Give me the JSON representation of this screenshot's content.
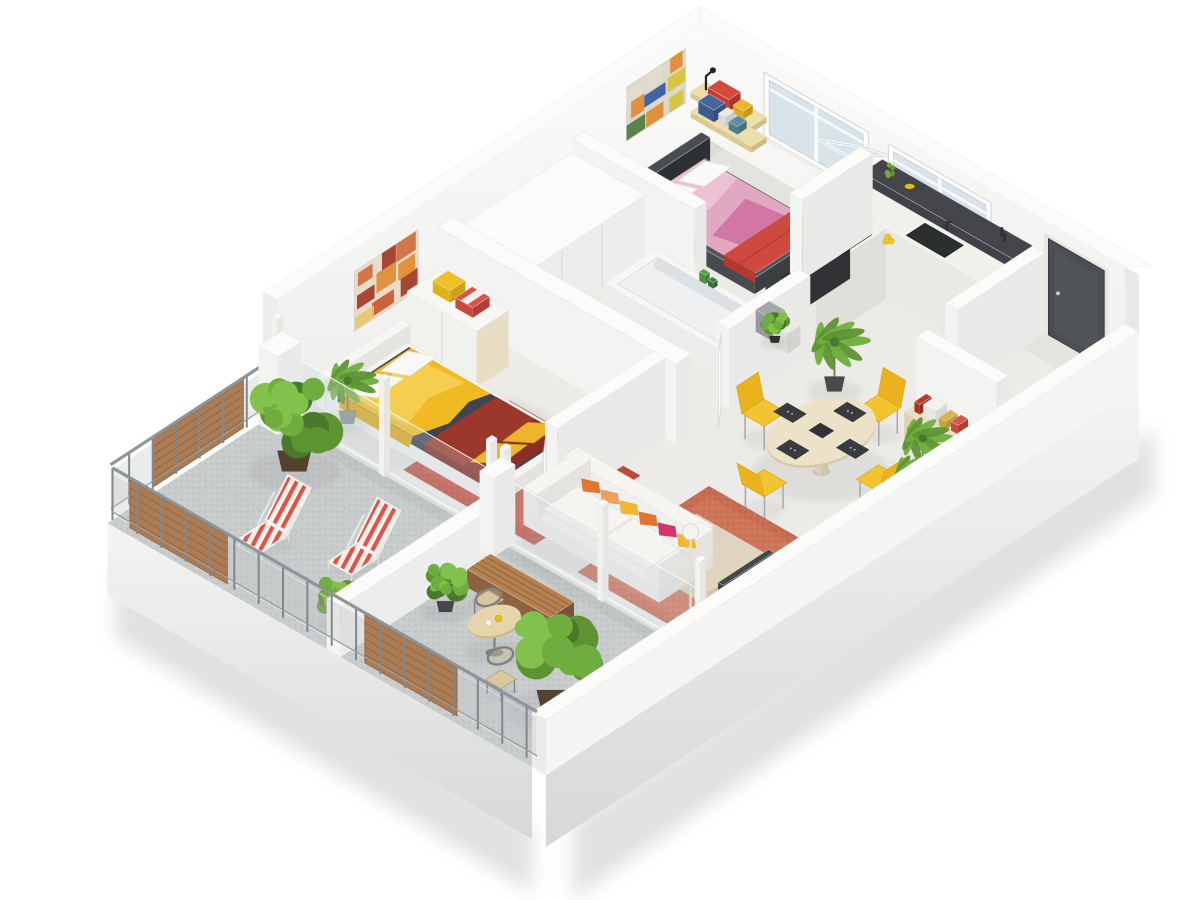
{
  "meta": {
    "app": "floor-plan-render",
    "description": "isometric 3d dollhouse cutaway of a two bedroom apartment with wraparound balcony"
  },
  "projection": {
    "ux": 0.87,
    "uy": 0.5,
    "vx": -0.84,
    "vy": 0.55,
    "ox": 700,
    "oy": 118
  },
  "palette": {
    "bg": "#ffffff",
    "wallTop": "#fbfbfa",
    "wallSE": "#e9eae8",
    "wallSW": "#f3f3f1",
    "floorIn": "#edebe7",
    "floorBalc": "#c9cccd",
    "glassWin": "#d8e4ea",
    "door": "#4b4e52",
    "counterDark": "#45464a",
    "counterWhite": "#f2f0ea",
    "sinkDark": "#2c2f31",
    "cooktop": "#141617",
    "tub": "#f5f6f5",
    "tubInner": "#eef0f1",
    "tan": "#e5d9b8",
    "woodShelf": "#e8dca6",
    "rugRed": "#c2483a",
    "rugTerra": "#c96b51",
    "bedDark": "#44474b",
    "pink": "#ecc2d2",
    "magenta": "#cf6f9f",
    "redThrow": "#cf4a3e",
    "mattressM": "#3f4451",
    "yellow": "#f0ba24",
    "yellowLight": "#f8d45c",
    "redRunner": "#9c372c",
    "sofaWhite": "#f1f0ed",
    "pillowOrange": "#e2762e",
    "pillowPeach": "#eda05e",
    "pillowYellow": "#f2b82c",
    "pillowMagenta": "#d6336c",
    "pillowCream": "#f0e8d8",
    "tableTan": "#ece2c8",
    "chairYellow": "#f3c431",
    "chairYellowDk": "#eab31e",
    "metal": "#85898b",
    "wood": "#ab7c54",
    "woodDark": "#8d6240",
    "planterBrown": "#54422f",
    "green1": "#6fae3e",
    "green2": "#5d9431",
    "green3": "#82c24c",
    "green4": "#49792a",
    "trunk": "#8a7a5a",
    "tvDark": "#35383b",
    "shadow": "#c7c9ca"
  },
  "scene": {
    "items": [
      {
        "t": "floor",
        "name": "indoor-floor",
        "p1": 16,
        "q1": 16,
        "p2": 504,
        "q2": 516,
        "fill": "floorIn"
      },
      {
        "t": "floor",
        "name": "balcony-floor",
        "p1": 16,
        "q1": 516,
        "p2": 504,
        "q2": 722,
        "fill": "floorBalc",
        "speck": true,
        "tiles": true
      },
      {
        "t": "wallshade",
        "name": "floor-shadow-nw",
        "pts": [
          [
            16,
            16,
            0
          ],
          [
            44,
            16,
            0
          ],
          [
            44,
            516,
            0
          ],
          [
            16,
            516,
            0
          ]
        ],
        "op": 0.05
      },
      {
        "t": "wallshade",
        "name": "floor-shadow-ne",
        "pts": [
          [
            16,
            16,
            0
          ],
          [
            504,
            16,
            0
          ],
          [
            504,
            44,
            0
          ],
          [
            16,
            44,
            0
          ]
        ],
        "op": 0.04
      },
      {
        "t": "wallshade",
        "name": "floor-shadow-balcony",
        "pts": [
          [
            16,
            516,
            0
          ],
          [
            504,
            516,
            0
          ],
          [
            504,
            534,
            0
          ],
          [
            16,
            534,
            0
          ]
        ],
        "op": 0.06
      },
      {
        "t": "softshadow",
        "name": "ground-shadow-se",
        "pts": [
          [
            520,
            24,
            -30
          ],
          [
            520,
            716,
            -44
          ],
          [
            520,
            716,
            -120
          ],
          [
            520,
            24,
            -95
          ]
        ],
        "dx": 22,
        "dy": 8
      },
      {
        "t": "softshadow",
        "name": "ground-shadow-sw",
        "pts": [
          [
            20,
            722,
            -44
          ],
          [
            500,
            722,
            -56
          ],
          [
            500,
            722,
            -122
          ],
          [
            20,
            722,
            -106
          ]
        ],
        "dx": 4,
        "dy": 6
      },
      {
        "t": "quad",
        "name": "base-slab-sw",
        "pts": [
          [
            16,
            722,
            0
          ],
          [
            504,
            722,
            0
          ],
          [
            504,
            722,
            -72
          ],
          [
            16,
            722,
            -72
          ]
        ],
        "fill": "url(#gBase)"
      },
      {
        "t": "facadeNW",
        "name": "northwest-wall"
      },
      {
        "t": "art",
        "name": "wall-art-multicolor",
        "q1": 34,
        "q2": 104,
        "h1": 42,
        "h2": 96,
        "bg": "#ddd8cc",
        "colors": [
          "#b33f35",
          "#2d56a0",
          "#e08a2c",
          "#e3dccd",
          "#d8c232",
          "#7a2f2f",
          "#4a7a3a",
          "#c84a3e",
          "#88a8c8"
        ],
        "seed": 7
      },
      {
        "t": "art",
        "name": "wall-art-orange",
        "q1": 352,
        "q2": 428,
        "h1": 30,
        "h2": 90,
        "bg": "#e8ddca",
        "colors": [
          "#c8552c",
          "#e08a2c",
          "#a03525",
          "#e8c86a",
          "#8a4a20",
          "#f0e2c8",
          "#d06a3a"
        ],
        "seed": 3
      },
      {
        "t": "facadeNE",
        "name": "northeast-wall"
      },
      {
        "t": "window",
        "name": "bedroom-window",
        "p1": 95,
        "p2": 203,
        "h1": 40,
        "h2": 94,
        "open": true
      },
      {
        "t": "window",
        "name": "kitchen-window",
        "p1": 238,
        "p2": 344,
        "h1": 44,
        "h2": 94
      },
      {
        "t": "door",
        "name": "entrance-door",
        "p1": 416,
        "p2": 480,
        "h": 96
      },
      {
        "t": "box",
        "name": "kitchen-back-counter",
        "p1": 225,
        "q1": 16,
        "p2": 398,
        "q2": 40,
        "h": 80,
        "top": "counterDark",
        "se": "#34363a",
        "sw": "#404247"
      },
      {
        "t": "kitchendecor",
        "name": "kitchen-decor"
      },
      {
        "t": "box",
        "name": "kitchen-counter",
        "p1": 225,
        "q1": 40,
        "p2": 398,
        "q2": 72,
        "h": 70,
        "top": "counterWhite",
        "se": "#e0ded8",
        "sw": "#ebe9e3"
      },
      {
        "t": "quadTop",
        "name": "kitchen-sink",
        "p1": 302,
        "q1": 45,
        "p2": 346,
        "q2": 67,
        "h": 70.5,
        "fill": "sinkDark",
        "stroke": "#1e2022"
      },
      {
        "t": "box",
        "name": "kitchen-peninsula",
        "p1": 225,
        "q1": 72,
        "p2": 283,
        "q2": 155,
        "h": 70,
        "top": "counterWhite",
        "se": "#e0ded8",
        "sw": "#ebe9e3"
      },
      {
        "t": "box",
        "name": "kitchen-peninsula-shelf",
        "p1": 225,
        "q1": 72,
        "p2": 242,
        "q2": 155,
        "h": 74,
        "top": "counterDark",
        "se": "#303236",
        "sw": "#3a3c40"
      },
      {
        "t": "quadTop",
        "name": "cooktop",
        "p1": 250,
        "q1": 86,
        "p2": 280,
        "q2": 122,
        "h": 70.5,
        "fill": "cooktop",
        "stroke": "#000000"
      },
      {
        "t": "pot",
        "name": "cooking-pot",
        "p": 263,
        "q": 100,
        "h": 70.5
      },
      {
        "t": "lemons",
        "name": "lemons",
        "p": 292,
        "q": 79,
        "h": 70.5
      },
      {
        "t": "shelves",
        "name": "wall-shelves"
      },
      {
        "t": "bed2",
        "name": "single-bed"
      },
      {
        "t": "wall",
        "name": "partition-wall",
        "p1": 200,
        "q1": 16,
        "p2": 214,
        "q2": 100
      },
      {
        "t": "wall",
        "name": "partition-wall",
        "p1": 16,
        "q1": 155,
        "p2": 157,
        "q2": 169
      },
      {
        "t": "wall",
        "name": "partition-wall",
        "p1": 398,
        "q1": 16,
        "p2": 412,
        "q2": 120
      },
      {
        "t": "wall",
        "name": "partition-wall",
        "p1": 412,
        "q1": 155,
        "p2": 504,
        "q2": 169
      },
      {
        "t": "box",
        "name": "hallway-closet",
        "p1": 16,
        "q1": 169,
        "p2": 100,
        "q2": 315,
        "h": 66,
        "top": "wallTop",
        "se": "#eceded",
        "sw": "#f4f4f2",
        "seamsSE": [
          220,
          268
        ]
      },
      {
        "t": "tub",
        "name": "bathtub",
        "p1": 118,
        "q1": 175,
        "p2": 268,
        "q2": 237
      },
      {
        "t": "wall",
        "name": "bathroom-wall",
        "p1": 276,
        "q1": 169,
        "p2": 290,
        "q2": 266
      },
      {
        "t": "doorleaf",
        "name": "bathroom-door",
        "a": [
          283,
          268
        ],
        "b": [
          301,
          290
        ]
      },
      {
        "t": "wall",
        "name": "partition-wall",
        "p1": 16,
        "q1": 311,
        "p2": 290,
        "q2": 329
      },
      {
        "t": "wardrobe",
        "name": "wardrobe"
      },
      {
        "t": "rug",
        "name": "red-rug",
        "p1": 148,
        "q1": 380,
        "p2": 298,
        "q2": 506,
        "fill": "rugRed",
        "inner": "#cb5244"
      },
      {
        "t": "bedM",
        "name": "double-bed"
      },
      {
        "t": "plantPalm",
        "name": "palm-plant",
        "p": 70,
        "q": 492,
        "s": 26,
        "pot": "#8a8f92"
      },
      {
        "t": "wall",
        "name": "partition-wall",
        "p1": 264,
        "q1": 329,
        "p2": 278,
        "q2": 458
      },
      {
        "t": "doorleaf",
        "name": "bedroom-door",
        "a": [
          271,
          464
        ],
        "b": [
          289,
          486
        ]
      },
      {
        "t": "stools",
        "name": "stools"
      },
      {
        "t": "plantPalm",
        "name": "palm-plant",
        "p": 338,
        "q": 190,
        "s": 30,
        "pot": "#4a4a4a"
      },
      {
        "t": "plantBush",
        "name": "potted-plant",
        "p": 256,
        "q": 176,
        "s": 13,
        "pot": "#2f2f2f"
      },
      {
        "t": "console",
        "name": "entry-console",
        "p1": 424,
        "q1": 172,
        "p2": 494,
        "q2": 196
      },
      {
        "t": "dining",
        "name": "dining-set",
        "cx": 405,
        "cy": 275
      },
      {
        "t": "plantPalm",
        "name": "palm-plant",
        "p": 476,
        "q": 228,
        "s": 26,
        "pot": "#8a8f92"
      },
      {
        "t": "plantPalm",
        "name": "palm-plant",
        "p": 492,
        "q": 260,
        "s": 21,
        "pot": "#8a8f92"
      },
      {
        "t": "rug",
        "name": "terracotta-rug",
        "p1": 350,
        "q1": 352,
        "p2": 498,
        "q2": 508,
        "fill": "rugTerra",
        "inner": "#d0775c"
      },
      {
        "t": "coffee",
        "name": "coffee-table"
      },
      {
        "t": "tvunit",
        "name": "tv-unit"
      },
      {
        "t": "sofa",
        "name": "sofa"
      },
      {
        "t": "lamp",
        "name": "floor-lamp",
        "p": 468,
        "q": 496
      },
      {
        "t": "glassrun",
        "name": "glass-wall",
        "p1": 16,
        "p2": 262,
        "q": 516,
        "posts": [
          16,
          139,
          262
        ]
      },
      {
        "t": "glassrun",
        "name": "glass-wall",
        "p1": 278,
        "p2": 502,
        "q": 516,
        "posts": [
          278,
          390,
          502
        ]
      },
      {
        "t": "railing",
        "name": "balcony-railing-nw",
        "axis": "v",
        "at": 12,
        "a1": 524,
        "a2": 714,
        "wood": [
          [
            556,
            664
          ]
        ]
      },
      {
        "t": "wall",
        "name": "balcony-pillar",
        "p1": 16,
        "q1": 514,
        "p2": 38,
        "q2": 542,
        "h": 78
      },
      {
        "t": "plantBush",
        "name": "balcony-tree",
        "p": 82,
        "q": 568,
        "s": 40,
        "pot": "planterBrown"
      },
      {
        "t": "deckchair",
        "name": "deck-chair",
        "p": 208,
        "q": 618
      },
      {
        "t": "deckchair",
        "name": "deck-chair",
        "p": 132,
        "q": 646
      },
      {
        "t": "plantBush",
        "name": "balcony-shrub",
        "p": 252,
        "q": 690,
        "s": 19,
        "pot": "planterBrown"
      },
      {
        "t": "box",
        "name": "balcony-divider",
        "p1": 268,
        "q1": 540,
        "p2": 284,
        "q2": 722,
        "h": 50,
        "top": "wallTop",
        "se": "#eceded",
        "sw": "#f4f4f2"
      },
      {
        "t": "wall",
        "name": "divider-pillar",
        "p1": 268,
        "q1": 514,
        "p2": 284,
        "q2": 540,
        "h": 78
      },
      {
        "t": "bench",
        "name": "bench",
        "p1": 296,
        "q1": 556,
        "p2": 392,
        "q2": 584
      },
      {
        "t": "bistrochair",
        "name": "bistro-chair",
        "p": 334,
        "q": 598,
        "side": -1
      },
      {
        "t": "plantBush",
        "name": "potted-tree",
        "p": 306,
        "q": 620,
        "s": 21,
        "pot": "#474747"
      },
      {
        "t": "bistro",
        "name": "bistro-table",
        "p": 374,
        "q": 632
      },
      {
        "t": "plantBush",
        "name": "balcony-bush",
        "p": 466,
        "q": 656,
        "s": 42,
        "pot": "planterBrown"
      },
      {
        "t": "bistrochair",
        "name": "bistro-chair",
        "p": 416,
        "q": 668,
        "side": 1
      },
      {
        "t": "quad",
        "name": "base-slab-se",
        "pts": [
          [
            520,
            16,
            0
          ],
          [
            520,
            722,
            0
          ],
          [
            520,
            722,
            -72
          ],
          [
            520,
            16,
            -72
          ]
        ],
        "fill": "url(#gBase)"
      },
      {
        "t": "box",
        "name": "southeast-parapet",
        "p1": 504,
        "q1": 16,
        "p2": 520,
        "q2": 722,
        "h": 55,
        "top": "wallTop",
        "se": "#f5f5f4",
        "sw": "#ebebea"
      },
      {
        "t": "railing",
        "name": "balcony-railing-sw",
        "axis": "u",
        "at": 716,
        "a1": 16,
        "a2": 504,
        "wood": [
          [
            36,
            148
          ],
          [
            306,
            412
          ]
        ]
      }
    ]
  }
}
